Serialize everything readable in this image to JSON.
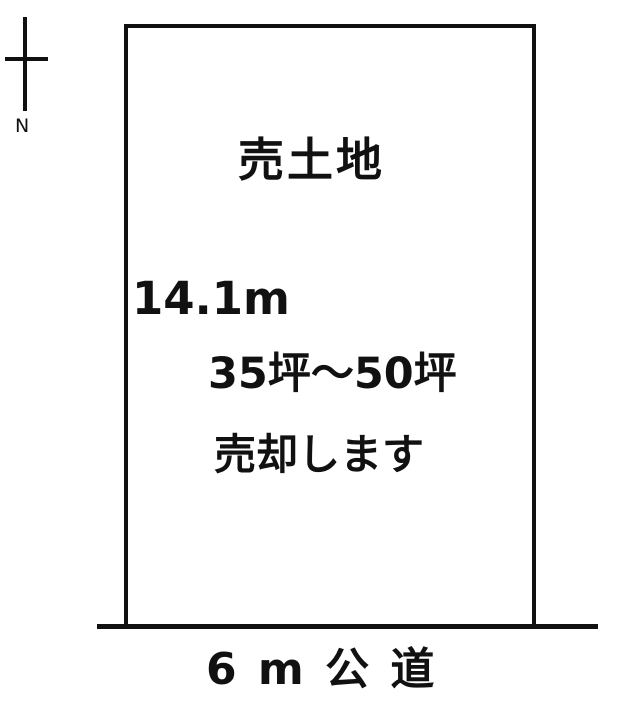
{
  "compass": {
    "label": "N"
  },
  "plot": {
    "title": "売土地",
    "width_label": "14.1m",
    "area_label": "35坪〜50坪",
    "sale_label": "売却します"
  },
  "road": {
    "label": "6 m 公 道"
  },
  "colors": {
    "ink": "#111111",
    "background": "#ffffff"
  }
}
